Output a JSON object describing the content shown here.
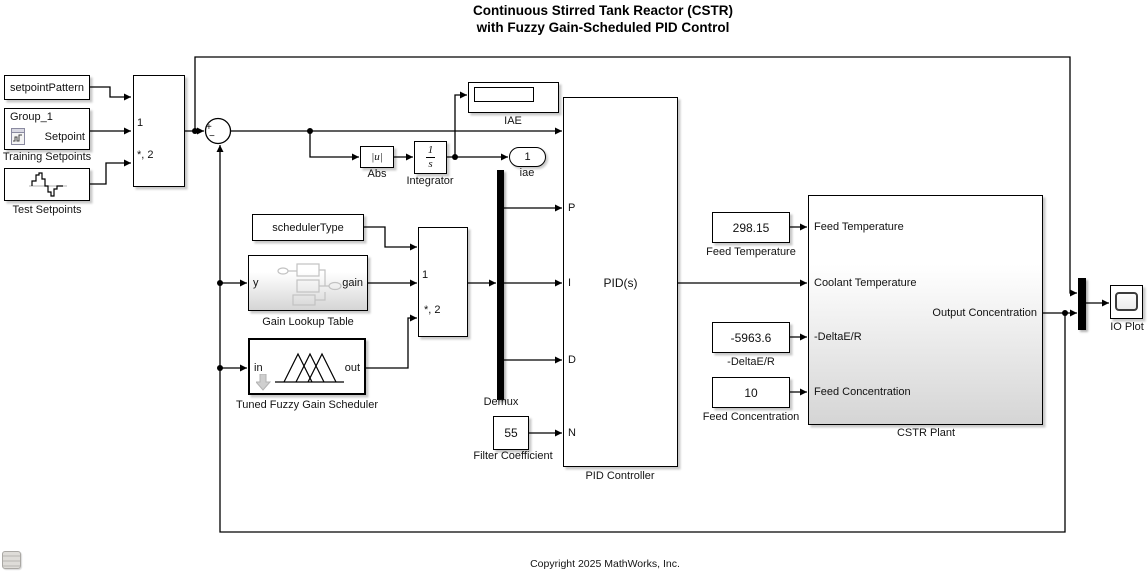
{
  "title": {
    "line1": "Continuous Stirred Tank Reactor (CSTR)",
    "line2": "with Fuzzy Gain-Scheduled PID Control"
  },
  "footer": {
    "copyright": "Copyright 2025 MathWorks, Inc."
  },
  "colors": {
    "wire": "#000000",
    "block_shadow": "#b9b9b9",
    "subsystem_gradient_bottom": "#d5d5d5"
  },
  "blocks": {
    "setpoint_pattern": {
      "text": "setpointPattern"
    },
    "training_setpoints": {
      "name": "Group_1",
      "port_label": "Setpoint",
      "label": "Training Setpoints"
    },
    "test_setpoints": {
      "label": "Test Setpoints"
    },
    "setpoint_switch": {
      "port_1": "1",
      "port_default": "*, 2"
    },
    "sum": {
      "plus": "+",
      "minus": "−"
    },
    "iae_display": {
      "label": "IAE"
    },
    "abs": {
      "text": "|u|",
      "label": "Abs"
    },
    "integrator": {
      "numerator": "1",
      "denominator": "s",
      "label": "Integrator"
    },
    "iae_outport": {
      "number": "1",
      "label": "iae"
    },
    "scheduler_type": {
      "text": "schedulerType"
    },
    "gain_lookup_table": {
      "in_port": "y",
      "out_port": "gain",
      "label": "Gain Lookup Table"
    },
    "fuzzy_scheduler": {
      "in_port": "in",
      "out_port": "out",
      "label": "Tuned Fuzzy Gain Scheduler"
    },
    "gain_switch": {
      "port_1": "1",
      "port_default": "*, 2"
    },
    "demux": {
      "label": "Demux"
    },
    "pid_controller": {
      "text": "PID(s)",
      "port_p": "P",
      "port_i": "I",
      "port_d": "D",
      "port_n": "N",
      "label": "PID Controller"
    },
    "filter_coefficient": {
      "value": "55",
      "label": "Filter Coefficient"
    },
    "feed_temperature": {
      "value": "298.15",
      "label": "Feed Temperature"
    },
    "delta_e_r": {
      "value": "-5963.6",
      "label": "-DeltaE/R"
    },
    "feed_concentration": {
      "value": "10",
      "label": "Feed Concentration"
    },
    "cstr_plant": {
      "in_feed_temperature": "Feed Temperature",
      "in_coolant_temperature": "Coolant Temperature",
      "in_delta_e_r": "-DeltaE/R",
      "in_feed_concentration": "Feed Concentration",
      "out_output_concentration": "Output Concentration",
      "label": "CSTR Plant"
    },
    "io_plot": {
      "label": "IO Plot"
    }
  }
}
